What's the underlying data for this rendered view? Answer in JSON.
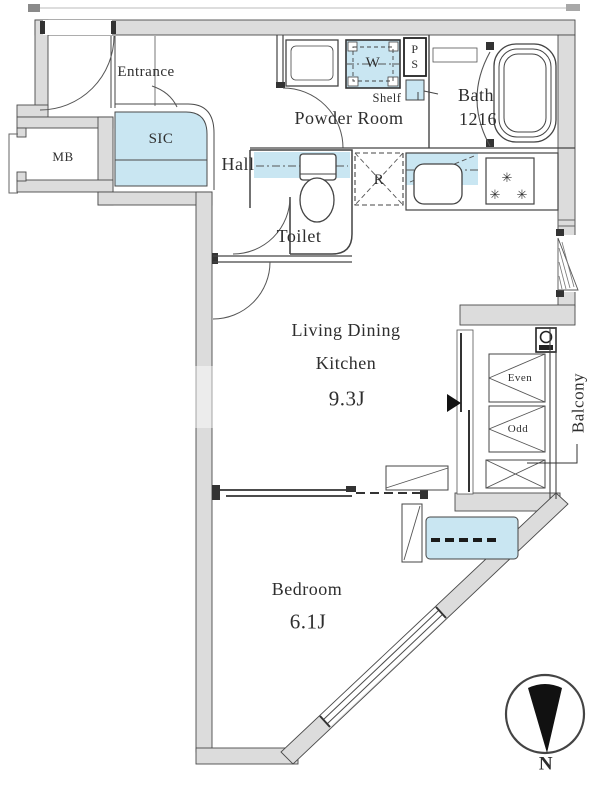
{
  "labels": {
    "entrance": "Entrance",
    "sic": "SIC",
    "mb": "MB",
    "hall": "Hall",
    "powder_room": "Powder Room",
    "shelf": "Shelf",
    "ps": "P\nS",
    "washer": "W",
    "bath": "Bath",
    "bath_size": "1216",
    "toilet": "Toilet",
    "refrigerator": "R",
    "ldk_line1": "Living Dining",
    "ldk_line2": "Kitchen",
    "ldk_size": "9.3J",
    "bedroom": "Bedroom",
    "bedroom_size": "6.1J",
    "balcony": "Balcony",
    "shutter_top": "Even",
    "shutter_bottom": "Odd",
    "compass_north": "N",
    "burner_glyph": "✳"
  },
  "colors": {
    "wall_fill": "#dcdcdc",
    "line": "#3f3f3f",
    "fixture_blue": "#c9e6f2",
    "compass": "#111111"
  }
}
